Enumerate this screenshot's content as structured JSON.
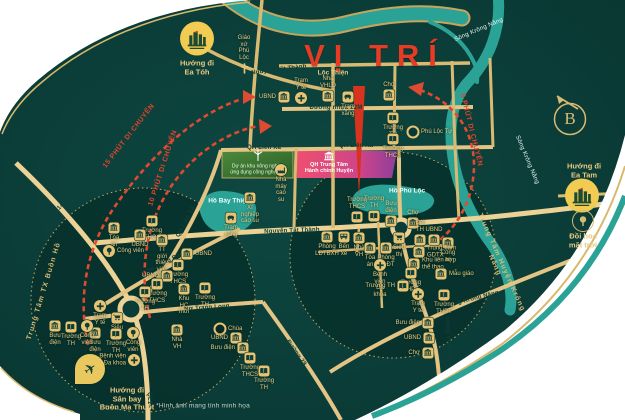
{
  "title": {
    "text": "VỊ TRÍ"
  },
  "compass": {
    "letter": "B"
  },
  "disclaimer": {
    "text": "*Hình ảnh mang tính minh họa"
  },
  "colors": {
    "background": "#0c403b",
    "road": "#ecd295",
    "water": "#2aa295",
    "accent_red": "#e6432c",
    "gold": "#e4c377",
    "pink_zone": "#e84b6f",
    "purple_zone": "#8f3f9c",
    "logo_yellow": "#f2cc52"
  },
  "zones": {
    "green": {
      "text": "Dự án khu nông nghiệp\nứng dụng công nghệ cao"
    },
    "admin": {
      "text": "QH Trung Tâm\nHành chính Huyện"
    }
  },
  "labels": {
    "road": [
      {
        "text": "Đường nhựa 22M",
        "x": 336,
        "y": 108,
        "rot": 0
      },
      {
        "text": "QH Liên Xã",
        "x": 264,
        "y": 148,
        "rot": 0
      },
      {
        "text": "QH Liên Xã",
        "x": 356,
        "y": 146,
        "rot": 0
      },
      {
        "text": "QH Liên Xã",
        "x": 186,
        "y": 222,
        "rot": -62
      },
      {
        "text": "Nguyễn Tất Thành",
        "x": 279,
        "y": 70,
        "rot": -7
      },
      {
        "text": "Nguyễn Tất Thành",
        "x": 292,
        "y": 231,
        "rot": -2
      },
      {
        "text": "Nguyễn Tất Thành",
        "x": 519,
        "y": 209,
        "rot": -4
      },
      {
        "text": "Nơ Trang Long",
        "x": 207,
        "y": 308,
        "rot": -4
      },
      {
        "text": "Trần Hưng Đạo",
        "x": 163,
        "y": 264,
        "rot": -27
      },
      {
        "text": "QL14",
        "x": 58,
        "y": 210,
        "rot": -47
      },
      {
        "text": "QL14",
        "x": 149,
        "y": 400,
        "rot": 90
      },
      {
        "text": "Đường 29",
        "x": 296,
        "y": 353,
        "rot": 55
      },
      {
        "text": "Hùng Vương",
        "x": 448,
        "y": 337,
        "rot": 86
      },
      {
        "text": "Đường Krông Năng",
        "x": 470,
        "y": 300,
        "rot": -14
      }
    ],
    "river": [
      {
        "text": "Sông Krông Năng",
        "x": 479,
        "y": 30,
        "rot": -23
      },
      {
        "text": "Sông Krông Năng",
        "x": 527,
        "y": 160,
        "rot": 67
      }
    ],
    "lake": [
      {
        "text": "Hồ Bảy Thiện",
        "x": 229,
        "y": 201,
        "rot": 0
      },
      {
        "text": "Hồ Phú Lộc",
        "x": 407,
        "y": 191,
        "rot": 0
      }
    ],
    "place": [
      {
        "text": "Lộc Thiện",
        "x": 333,
        "y": 73,
        "rot": 0
      }
    ],
    "arc": [
      {
        "text": "15 PHÚT DI CHUYỂN",
        "x": 129,
        "y": 136,
        "rot": -52
      },
      {
        "text": "10 PHÚT DI CHUYỂN",
        "x": 163,
        "y": 168,
        "rot": -72
      },
      {
        "text": "5 PHÚT DI CHUYỂN",
        "x": 471,
        "y": 130,
        "rot": 76
      }
    ],
    "center": [
      {
        "text": "Trung Tâm TX Buôn Hồ",
        "x": 44,
        "y": 291,
        "rot": -73
      },
      {
        "text": "Trung Tâm Huyện Krông Năng",
        "x": 498,
        "y": 264,
        "rot": 66
      }
    ]
  },
  "directions": [
    {
      "id": "ea-toh",
      "text": "Hướng đi\nEa Tóh",
      "x": 197,
      "y": 68,
      "marker": "logo",
      "mx": 197,
      "my": 41
    },
    {
      "id": "ea-tam",
      "text": "Hướng đi\nEa Tam",
      "x": 584,
      "y": 171,
      "marker": "logo",
      "mx": 582,
      "my": 198
    },
    {
      "id": "doi-hoa",
      "text": "Đồi hoa\nmặt trời",
      "x": 583,
      "y": 241,
      "marker": "ringtree",
      "mx": 583,
      "my": 221
    },
    {
      "id": "airport",
      "text": "Hướng đi\nSân bay\nBuôn Ma Thuột",
      "x": 127,
      "y": 399,
      "marker": "pin",
      "mx": 90,
      "my": 369
    }
  ],
  "pois": [
    {
      "icon": "bank",
      "label": "UBND",
      "x": 284,
      "y": 97,
      "lp": "left"
    },
    {
      "icon": "cross",
      "label": "Trạm Y tế",
      "x": 301,
      "y": 98,
      "lp": "above"
    },
    {
      "icon": "bank",
      "label": "Nhà VHLĐ",
      "x": 328,
      "y": 96,
      "lp": "above"
    },
    {
      "icon": "gas",
      "label": "Trạm xăng",
      "x": 348,
      "y": 97,
      "lp": "below"
    },
    {
      "icon": "bank",
      "label": "Chợ",
      "x": 389,
      "y": 95,
      "lp": "above"
    },
    {
      "icon": "book",
      "label": "Trường TH",
      "x": 393,
      "y": 118,
      "lp": "below"
    },
    {
      "icon": "book",
      "label": "Trường THCS",
      "x": 393,
      "y": 139,
      "lp": "below"
    },
    {
      "icon": "ring",
      "label": "Phú Lộc Tự",
      "x": 413,
      "y": 132,
      "lp": "right"
    },
    {
      "icon": "church",
      "label": "Giáo xứ\nPhú Lộc",
      "x": 244,
      "y": 68,
      "lp": "above"
    },
    {
      "icon": "factory",
      "label": "Nhà máy\ncao su",
      "x": 281,
      "y": 170,
      "lp": "below"
    },
    {
      "icon": "bank",
      "label": "Xí nghiệp\ncao su",
      "x": 250,
      "y": 198,
      "lp": "below"
    },
    {
      "icon": "gas",
      "label": "Trạm xăng",
      "x": 231,
      "y": 218,
      "lp": "below"
    },
    {
      "icon": "book",
      "label": "Trường THCS",
      "x": 357,
      "y": 217,
      "lp": "above"
    },
    {
      "icon": "book",
      "label": "Trường TH",
      "x": 374,
      "y": 216,
      "lp": "above"
    },
    {
      "icon": "bank",
      "label": "Bưu điện",
      "x": 391,
      "y": 221,
      "lp": "above"
    },
    {
      "icon": "bank",
      "label": "Chợ",
      "x": 413,
      "y": 223,
      "lp": "above"
    },
    {
      "icon": "bank",
      "label": "Đài TH",
      "x": 420,
      "y": 240,
      "lp": "above"
    },
    {
      "icon": "bank",
      "label": "UBND",
      "x": 434,
      "y": 240,
      "lp": "above"
    },
    {
      "icon": "bank",
      "label": "Công an",
      "x": 448,
      "y": 243,
      "lp": "below"
    },
    {
      "icon": "bank",
      "label": "Phòng LĐTBXH",
      "x": 327,
      "y": 237,
      "lp": "below"
    },
    {
      "icon": "bus",
      "label": "Bến xe",
      "x": 344,
      "y": 237,
      "lp": "below"
    },
    {
      "icon": "bank",
      "label": "Nhà VH",
      "x": 359,
      "y": 238,
      "lp": "below"
    },
    {
      "icon": "cart",
      "label": "Siêu thị",
      "x": 399,
      "y": 238,
      "lp": "below"
    },
    {
      "icon": "bank",
      "label": "Tòa án",
      "x": 370,
      "y": 248,
      "lp": "below"
    },
    {
      "icon": "bank",
      "label": "Phòng\nGDĐT",
      "x": 386,
      "y": 248,
      "lp": "below"
    },
    {
      "icon": "cross",
      "label": "Bệnh viện\nĐa khoa",
      "x": 380,
      "y": 265,
      "lp": "below"
    },
    {
      "icon": "bank",
      "label": "Trung Tâm\nGDTX",
      "x": 419,
      "y": 252,
      "lp": "right"
    },
    {
      "icon": "bank",
      "label": "Khu liên hợp\nthể thao",
      "x": 414,
      "y": 264,
      "lp": "right"
    },
    {
      "icon": "bank",
      "label": "Mẫu giáo",
      "x": 441,
      "y": 274,
      "lp": "right"
    },
    {
      "icon": "book",
      "label": "Trường THPT",
      "x": 411,
      "y": 273,
      "lp": "below"
    },
    {
      "icon": "book",
      "label": "Trường TH",
      "x": 403,
      "y": 286,
      "lp": "left"
    },
    {
      "icon": "cross",
      "label": "Trạm Y tế",
      "x": 418,
      "y": 294,
      "lp": "below"
    },
    {
      "icon": "book",
      "label": "Trường THPT",
      "x": 444,
      "y": 295,
      "lp": "below"
    },
    {
      "icon": "bank",
      "label": "Bưu điện",
      "x": 428,
      "y": 323,
      "lp": "left"
    },
    {
      "icon": "bank",
      "label": "UBND",
      "x": 429,
      "y": 338,
      "lp": "left"
    },
    {
      "icon": "bank",
      "label": "Chợ",
      "x": 428,
      "y": 353,
      "lp": "left"
    },
    {
      "icon": "bank",
      "label": "Tòa án",
      "x": 114,
      "y": 228,
      "lp": "below"
    },
    {
      "icon": "tree",
      "label": "Công viên",
      "x": 109,
      "y": 251,
      "lp": "right"
    },
    {
      "icon": "book",
      "label": "Trường THCS",
      "x": 152,
      "y": 221,
      "lp": "below"
    },
    {
      "icon": "bank",
      "label": "UBND",
      "x": 140,
      "y": 235,
      "lp": "below"
    },
    {
      "icon": "bank",
      "label": "TT giới thiệu\nviệc làm",
      "x": 162,
      "y": 240,
      "lp": "below"
    },
    {
      "icon": "bank",
      "label": "UBND",
      "x": 187,
      "y": 254,
      "lp": "right"
    },
    {
      "icon": "book",
      "label": "Trường THCS",
      "x": 178,
      "y": 265,
      "lp": "below"
    },
    {
      "icon": "bank",
      "label": "UBND",
      "x": 167,
      "y": 276,
      "lp": "left"
    },
    {
      "icon": "book",
      "label": "Trường THCS",
      "x": 157,
      "y": 284,
      "lp": "below"
    },
    {
      "icon": "book",
      "label": "Trường TH",
      "x": 145,
      "y": 292,
      "lp": "below"
    },
    {
      "icon": "bank",
      "label": "Khu HC mới",
      "x": 184,
      "y": 289,
      "lp": "below"
    },
    {
      "icon": "book",
      "label": "Trường TH",
      "x": 205,
      "y": 288,
      "lp": "below"
    },
    {
      "icon": "cross",
      "label": "Trạm Y tế",
      "x": 100,
      "y": 306,
      "lp": "below"
    },
    {
      "icon": "cart",
      "label": "Siêu thị",
      "x": 117,
      "y": 318,
      "lp": "below"
    },
    {
      "icon": "bank",
      "label": "Bưu điện",
      "x": 95,
      "y": 333,
      "lp": "below"
    },
    {
      "icon": "book",
      "label": "Trường TH",
      "x": 116,
      "y": 334,
      "lp": "below"
    },
    {
      "icon": "tree",
      "label": "Công viên",
      "x": 133,
      "y": 333,
      "lp": "below"
    },
    {
      "icon": "cross",
      "label": "Bệnh viện\nĐa khoa",
      "x": 134,
      "y": 360,
      "lp": "left"
    },
    {
      "icon": "bank",
      "label": "Nhà VH",
      "x": 177,
      "y": 330,
      "lp": "below"
    },
    {
      "icon": "ring",
      "label": "Chùa",
      "x": 220,
      "y": 329,
      "lp": "right"
    },
    {
      "icon": "bank",
      "label": "UBND",
      "x": 236,
      "y": 338,
      "lp": "left"
    },
    {
      "icon": "bank",
      "label": "Bưu điện",
      "x": 243,
      "y": 348,
      "lp": "left"
    },
    {
      "icon": "book",
      "label": "Trường THCS",
      "x": 250,
      "y": 358,
      "lp": "below"
    },
    {
      "icon": "book",
      "label": "Trường TH",
      "x": 264,
      "y": 371,
      "lp": "below"
    },
    {
      "icon": "bank",
      "label": "Bưu điện",
      "x": 55,
      "y": 326,
      "lp": "below"
    },
    {
      "icon": "book",
      "label": "Trường TH",
      "x": 71,
      "y": 327,
      "lp": "below"
    },
    {
      "icon": "tree",
      "label": "Công viên",
      "x": 87,
      "y": 326,
      "lp": "below"
    }
  ]
}
